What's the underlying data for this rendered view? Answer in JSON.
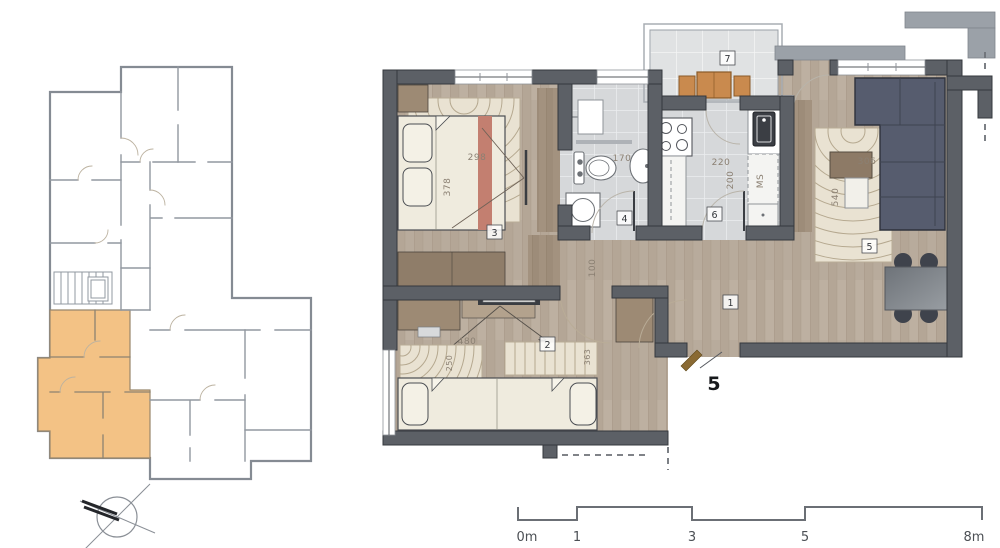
{
  "page": {
    "type": "apartment-floor-plan-drawing",
    "background": "#ffffff"
  },
  "palette": {
    "wall": "#5c6066",
    "wall_light": "#9ba1a8",
    "outline": "#35383d",
    "highlight_unit": "#f3c285",
    "wood_floor": "#b8ab9c",
    "wood_dark": "#a3927f",
    "tile": "#d6d8da",
    "balcony_tile": "#e0e2e3",
    "sofa": "#565c6e",
    "furniture_wood": "#c98a4e",
    "bed_cream": "#efebde",
    "rug": "#e9e2d2",
    "accent_red": "#c37f70",
    "dim_text": "#8b8073",
    "scale_line": "#6b6f75"
  },
  "overview": {
    "highlighted_unit": "5",
    "compass": "north-arrow"
  },
  "rooms": [
    {
      "number": "1",
      "name": "hallway",
      "dims": [
        "100"
      ]
    },
    {
      "number": "2",
      "name": "bedroom-2",
      "dims": [
        "480",
        "250",
        "363"
      ]
    },
    {
      "number": "3",
      "name": "bedroom-1",
      "dims": [
        "298",
        "378"
      ]
    },
    {
      "number": "4",
      "name": "bathroom",
      "dims": [
        "170"
      ]
    },
    {
      "number": "5",
      "name": "living-room",
      "dims": [
        "540",
        "306"
      ]
    },
    {
      "number": "6",
      "name": "kitchen",
      "dims": [
        "220",
        "200",
        "MS"
      ]
    },
    {
      "number": "7",
      "name": "balcony",
      "dims": []
    }
  ],
  "entrance": {
    "unit_number": "5"
  },
  "scale_bar": {
    "labels": [
      "0m",
      "1",
      "3",
      "5",
      "8m"
    ]
  }
}
